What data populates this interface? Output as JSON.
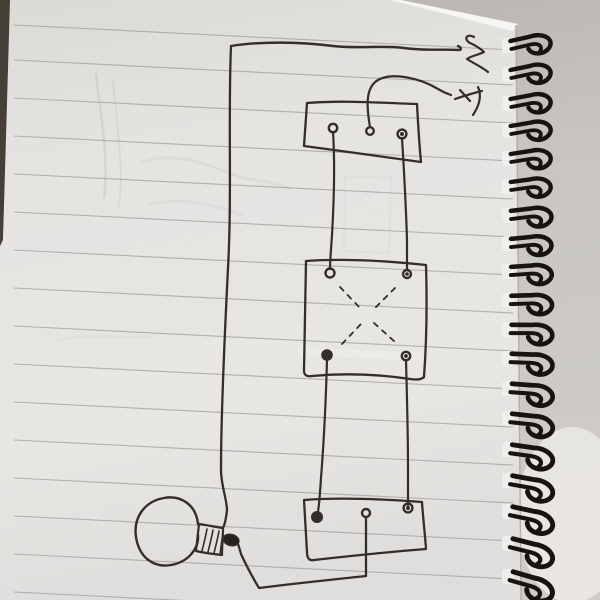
{
  "scene": {
    "description": "Photograph of a spiral-bound notebook page with a hand-drawn light-switch wiring diagram: two 3-terminal switch boxes, a 4-terminal crossover switch box with dashed X, a light bulb with hatched screw socket, and supply wire ends marked with a squiggle and a scrawled symbol at top right",
    "colors": {
      "ink": "#332e2a",
      "page": "#e6e4e1",
      "rule_line": "#9b9997",
      "table": "#463f37",
      "background": "#c2bfbb",
      "background_light": "#edebe8",
      "binding_wire": "#17140f",
      "paper_edge": "#f7f6f4"
    }
  },
  "diagram": {
    "type": "hand-drawn-circuit",
    "components": [
      {
        "name": "supply-wire-ends",
        "detail": "two wires exiting top right, one ending in a zigzag squiggle, one at a scrawled arrow-like mark"
      },
      {
        "name": "top-switch-box",
        "detail": "rectangle with 3 screw terminals; middle terminal wired to supply, outer terminals are travelers"
      },
      {
        "name": "four-way-switch-box",
        "detail": "square with 4 corner terminals and dashed X crossover lines"
      },
      {
        "name": "bottom-switch-box",
        "detail": "rectangle with 3 screw terminals; middle terminal wired to bulb tip"
      },
      {
        "name": "light-bulb",
        "detail": "round globe, hatched screw socket, dark contact tip, fed by long left-hand wire"
      }
    ],
    "wire_runs": [
      "long wire from top-left corner down left side of page into bulb socket",
      "wavy wire across page top to squiggle end",
      "curved wire from top box middle terminal to scrawled mark",
      "two traveler wires from top box down to four-way box",
      "two traveler wires from four-way box down to bottom box",
      "return wire from bottom box middle terminal along page bottom up to bulb tip"
    ]
  },
  "drawing": {
    "page": {
      "polygon": "10,0 396,0 516,25 521,600 0,600 0,246 3,240",
      "table_strip": "0,0 11,0 3,240 0,247",
      "table_color": "#463f37",
      "edge_highlight": "390,0 401,0 518,24 513,31",
      "edge_highlight_color": "#f7f6f4",
      "edge_shade": "#a8a5a1",
      "light_blob": "#edebe8"
    },
    "rules": {
      "x1": 14,
      "x2": 513,
      "rise": 25,
      "color": "#9b9997",
      "width": 1.1,
      "opacity": 0.7,
      "y": [
        25,
        60,
        98,
        136,
        174,
        212,
        250,
        288,
        326,
        364,
        402,
        440,
        478,
        516,
        554,
        592
      ]
    },
    "ghosts": [
      {
        "name": "pencil-ghost-1",
        "d": "M96,74 C101,118 109,158 104,198",
        "w": 2.5,
        "o": 0.14
      },
      {
        "name": "pencil-ghost-2",
        "d": "M113,80 C117,128 124,168 119,206",
        "w": 2,
        "o": 0.11
      },
      {
        "name": "pencil-ghost-3",
        "d": "M142,162 C168,152 198,160 224,171 C250,183 270,179 290,189",
        "w": 3,
        "o": 0.09
      },
      {
        "name": "pencil-ghost-4",
        "d": "M150,205 C178,196 214,204 242,215",
        "w": 3,
        "o": 0.07
      },
      {
        "name": "pencil-ghost-box",
        "d": "M345,176 L391,178 L389,253 L344,251 L345,176",
        "w": 2,
        "o": 0.06
      },
      {
        "name": "pencil-ghost-5",
        "d": "M60,340 C90,332 120,340 150,336",
        "w": 2.5,
        "o": 0.06
      },
      {
        "name": "whiteout-smudge",
        "d": "M301,352 L418,356",
        "w": 8,
        "o": 0.5,
        "color": "#f1f0ee"
      }
    ],
    "ink": [
      {
        "name": "left-long-wire",
        "d": "M231,46 C228,115 232,195 228,268 C224,348 221,420 221,470 C221,485 227,500 227,510 C226,519 225,524 223,528",
        "w": 2.3
      },
      {
        "name": "top-supply-wire",
        "d": "M231,46 C262,41 300,42 333,46 C359,49 383,45 404,48 C425,51 445,49 459,50 C462,50 461,47 458,46",
        "w": 2.4
      },
      {
        "name": "supply-squiggle",
        "d": "M474,37 C467,33 463,39 470,43 C475,45 481,49 484,52 C478,55 471,56 467,59 C473,63 482,67 488,72",
        "w": 2.2
      },
      {
        "name": "hot-lead-curve",
        "d": "M370,127 C366,104 366,87 378,80 C392,72 420,78 438,89 C443,92 448,94 451,95",
        "w": 2.2
      },
      {
        "name": "scrawl-mark-stroke-1",
        "d": "M455,99 C464,96 473,93 482,91",
        "w": 2.2
      },
      {
        "name": "scrawl-mark-stroke-2",
        "d": "M478,87 C482,96 479,106 473,115",
        "w": 2.2
      },
      {
        "name": "scrawl-mark-stroke-3",
        "d": "M460,90 L470,101",
        "w": 2.2
      },
      {
        "name": "top-switch-box-outline",
        "d": "M307,103 C344,100 381,103 417,104 C418,122 419,142 421,162 C383,157 343,151 304,146 C305,131 306,117 307,103",
        "w": 2.3
      },
      {
        "name": "traveler-wire-left-upper",
        "d": "M333,132 C335,162 334,200 332,235 C331,250 330,261 330,269",
        "w": 2.2
      },
      {
        "name": "traveler-wire-right-upper",
        "d": "M402,138 C404,170 406,208 407,240 C407,253 407,263 407,270",
        "w": 2.2
      },
      {
        "name": "four-way-box-outline",
        "d": "M306,261 C346,258 388,261 426,265 C427,298 427,336 424,377 C421,380 416,380 410,379 C377,374 344,373 312,376 C307,377 304,375 304,371 C305,334 305,297 306,261",
        "w": 2.3
      },
      {
        "name": "traveler-wire-left-lower",
        "d": "M327,360 C326,396 324,440 321,478 C320,494 319,505 318,512",
        "w": 2.2
      },
      {
        "name": "traveler-wire-right-lower",
        "d": "M406,361 C407,396 408,438 408,468 C408,484 408,497 408,505",
        "w": 2.2
      },
      {
        "name": "bottom-switch-box-outline",
        "d": "M304,500 C341,497 382,499 422,502 C423,518 425,534 426,549 C388,552 350,556 314,560 C309,561 307,558 307,552 C306,534 305,517 304,500",
        "w": 2.3
      },
      {
        "name": "bulb-return-wire",
        "d": "M366,517 C366,540 366,562 366,576 C338,579 298,583 259,588 C253,578 246,565 241,554 C240,550 239,547 238,544",
        "w": 2.3
      },
      {
        "name": "bulb-globe",
        "d": "M198,524 C196,504 180,495 164,498 C146,501 133,516 136,537 C139,557 153,568 171,565 C188,562 199,549 198,535",
        "w": 2.4
      },
      {
        "name": "socket-outline",
        "d": "M199,524 C207,525 215,527 223,528 C223,537 222,546 222,555 C213,554 204,553 196,551 C197,542 198,533 199,524",
        "w": 2.2
      },
      {
        "name": "socket-hatch-1",
        "d": "M202,551 C204,543 206,535 207,529",
        "w": 1.6
      },
      {
        "name": "socket-hatch-2",
        "d": "M208,552 C210,544 212,536 213,530",
        "w": 1.6
      },
      {
        "name": "socket-hatch-3",
        "d": "M214,553 C216,545 218,537 219,531",
        "w": 1.6
      },
      {
        "name": "socket-hatch-4",
        "d": "M220,554 C221,546 222,538 223,532",
        "w": 1.4
      }
    ],
    "dashes": [
      {
        "name": "crossover-dash-tl",
        "d": "M340,287 L361,309"
      },
      {
        "name": "crossover-dash-tr",
        "d": "M395,288 L374,309"
      },
      {
        "name": "crossover-dash-bl",
        "d": "M342,344 L361,324"
      },
      {
        "name": "crossover-dash-br",
        "d": "M394,341 L374,323"
      }
    ],
    "terminals": [
      {
        "name": "top-box-terminal-left",
        "cx": 333,
        "cy": 128,
        "r": 4.2,
        "style": "ring"
      },
      {
        "name": "top-box-terminal-middle",
        "cx": 370,
        "cy": 131,
        "r": 3.8,
        "style": "ring"
      },
      {
        "name": "top-box-terminal-right",
        "cx": 402,
        "cy": 134,
        "r": 4.4,
        "style": "ring-dot"
      },
      {
        "name": "four-way-terminal-top-left",
        "cx": 330,
        "cy": 273,
        "r": 4.5,
        "style": "ring"
      },
      {
        "name": "four-way-terminal-top-right",
        "cx": 407,
        "cy": 274,
        "r": 4.0,
        "style": "ring-dot"
      },
      {
        "name": "four-way-terminal-bottom-left",
        "cx": 327,
        "cy": 355,
        "r": 4.8,
        "style": "filled"
      },
      {
        "name": "four-way-terminal-bottom-right",
        "cx": 406,
        "cy": 356,
        "r": 4.2,
        "style": "ring-dot"
      },
      {
        "name": "bottom-box-terminal-left",
        "cx": 317,
        "cy": 517,
        "r": 5,
        "style": "filled"
      },
      {
        "name": "bottom-box-terminal-middle",
        "cx": 366,
        "cy": 513,
        "r": 4,
        "style": "ring"
      },
      {
        "name": "bottom-box-terminal-right",
        "cx": 408,
        "cy": 508,
        "r": 4.4,
        "style": "ring-dot"
      }
    ],
    "bulb_tip": {
      "cx": 231,
      "cy": 540,
      "rx": 8,
      "ry": 5.5,
      "rot": 14
    },
    "binding": {
      "x": 511,
      "stroke_width": 4.4,
      "outer": "M0,-5 L20,-7 C33,-10 44,-2 38,6 C32,13 20,12 17,5",
      "inner": "M0,3 L19,1 C28,0 32,4 28,9",
      "hole": {
        "x": 502,
        "y": -8,
        "w": 12,
        "h": 15,
        "rx": 3,
        "fill": "#f1f0ee"
      },
      "coils": [
        {
          "y": 46,
          "rot": -7,
          "s": 1.0
        },
        {
          "y": 75,
          "rot": -6,
          "s": 1.0
        },
        {
          "y": 104,
          "rot": -5,
          "s": 1.0
        },
        {
          "y": 131,
          "rot": -4,
          "s": 1.0
        },
        {
          "y": 159,
          "rot": -3,
          "s": 1.0
        },
        {
          "y": 187,
          "rot": -2,
          "s": 1.0
        },
        {
          "y": 216,
          "rot": -1,
          "s": 1.02
        },
        {
          "y": 244,
          "rot": 0,
          "s": 1.02
        },
        {
          "y": 272,
          "rot": 2,
          "s": 1.03
        },
        {
          "y": 301,
          "rot": 4,
          "s": 1.04
        },
        {
          "y": 330,
          "rot": 6,
          "s": 1.05
        },
        {
          "y": 359,
          "rot": 8,
          "s": 1.06
        },
        {
          "y": 389,
          "rot": 10,
          "s": 1.07
        },
        {
          "y": 419,
          "rot": 12,
          "s": 1.08
        },
        {
          "y": 450,
          "rot": 14,
          "s": 1.09
        },
        {
          "y": 481,
          "rot": 16,
          "s": 1.1
        },
        {
          "y": 512,
          "rot": 18,
          "s": 1.11
        },
        {
          "y": 544,
          "rot": 20,
          "s": 1.12
        },
        {
          "y": 577,
          "rot": 22,
          "s": 1.13
        }
      ]
    }
  }
}
